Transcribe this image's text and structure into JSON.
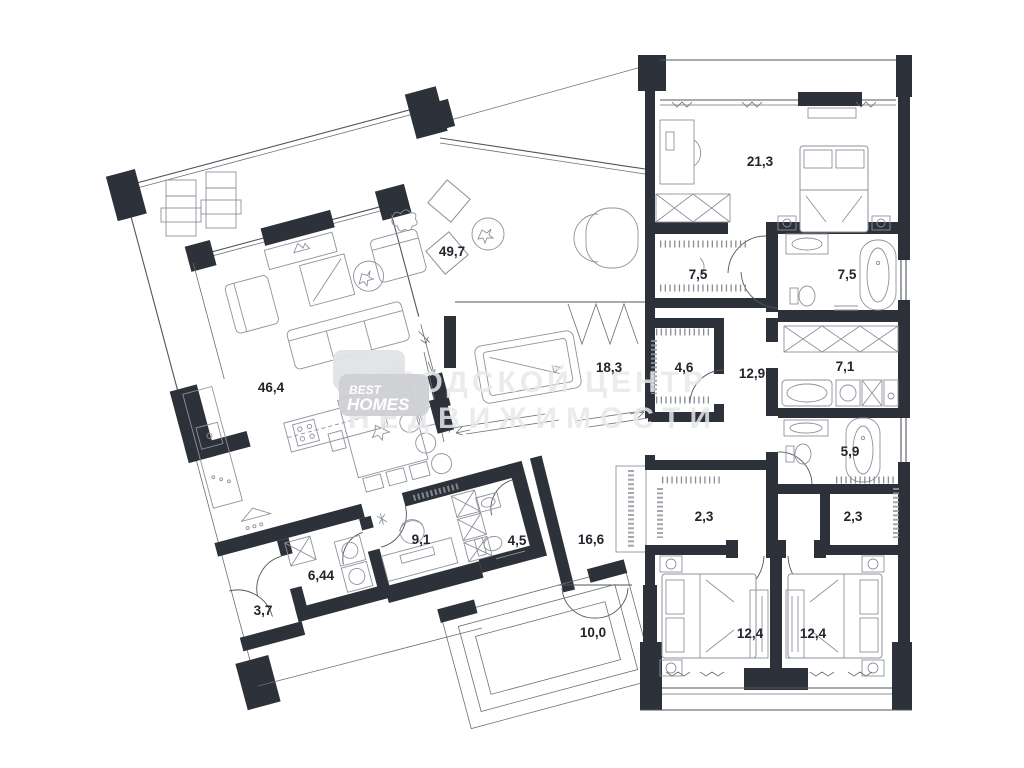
{
  "watermark": {
    "brand_line1": "ГОРОДСКОЙ ЦЕНТР",
    "brand_line2": "НЕДВИЖИМОСТИ",
    "logo_line1": "BEST",
    "logo_line2": "HOMES"
  },
  "colors": {
    "wall": "#2d323a",
    "thin_line": "#50555d",
    "furniture_line": "#8d929c",
    "watermark_gray": "#e7e8eb",
    "label_dark": "#22252b",
    "background": "#ffffff"
  },
  "plan": {
    "type": "residential-floor-plan",
    "rooms": [
      {
        "name": "living-kitchen",
        "area": "46,4"
      },
      {
        "name": "terrace",
        "area": "49,7"
      },
      {
        "name": "billiard-room",
        "area": "18,3"
      },
      {
        "name": "walk-in-closet",
        "area": "4,6"
      },
      {
        "name": "hallway",
        "area": "12,9"
      },
      {
        "name": "wardrobe",
        "area": "7,5"
      },
      {
        "name": "bathroom-master",
        "area": "7,5"
      },
      {
        "name": "laundry",
        "area": "7,1"
      },
      {
        "name": "bathroom-second",
        "area": "5,9"
      },
      {
        "name": "closet-left",
        "area": "2,3"
      },
      {
        "name": "closet-right",
        "area": "2,3"
      },
      {
        "name": "bedroom-left",
        "area": "12,4"
      },
      {
        "name": "bedroom-right",
        "area": "12,4"
      },
      {
        "name": "bedroom-master",
        "area": "21,3"
      },
      {
        "name": "entrance-hall",
        "area": "16,6"
      },
      {
        "name": "office",
        "area": "9,1"
      },
      {
        "name": "wc",
        "area": "4,5"
      },
      {
        "name": "utility",
        "area": "6,44"
      },
      {
        "name": "vestibule",
        "area": "3,7"
      },
      {
        "name": "porch",
        "area": "10,0"
      }
    ]
  }
}
